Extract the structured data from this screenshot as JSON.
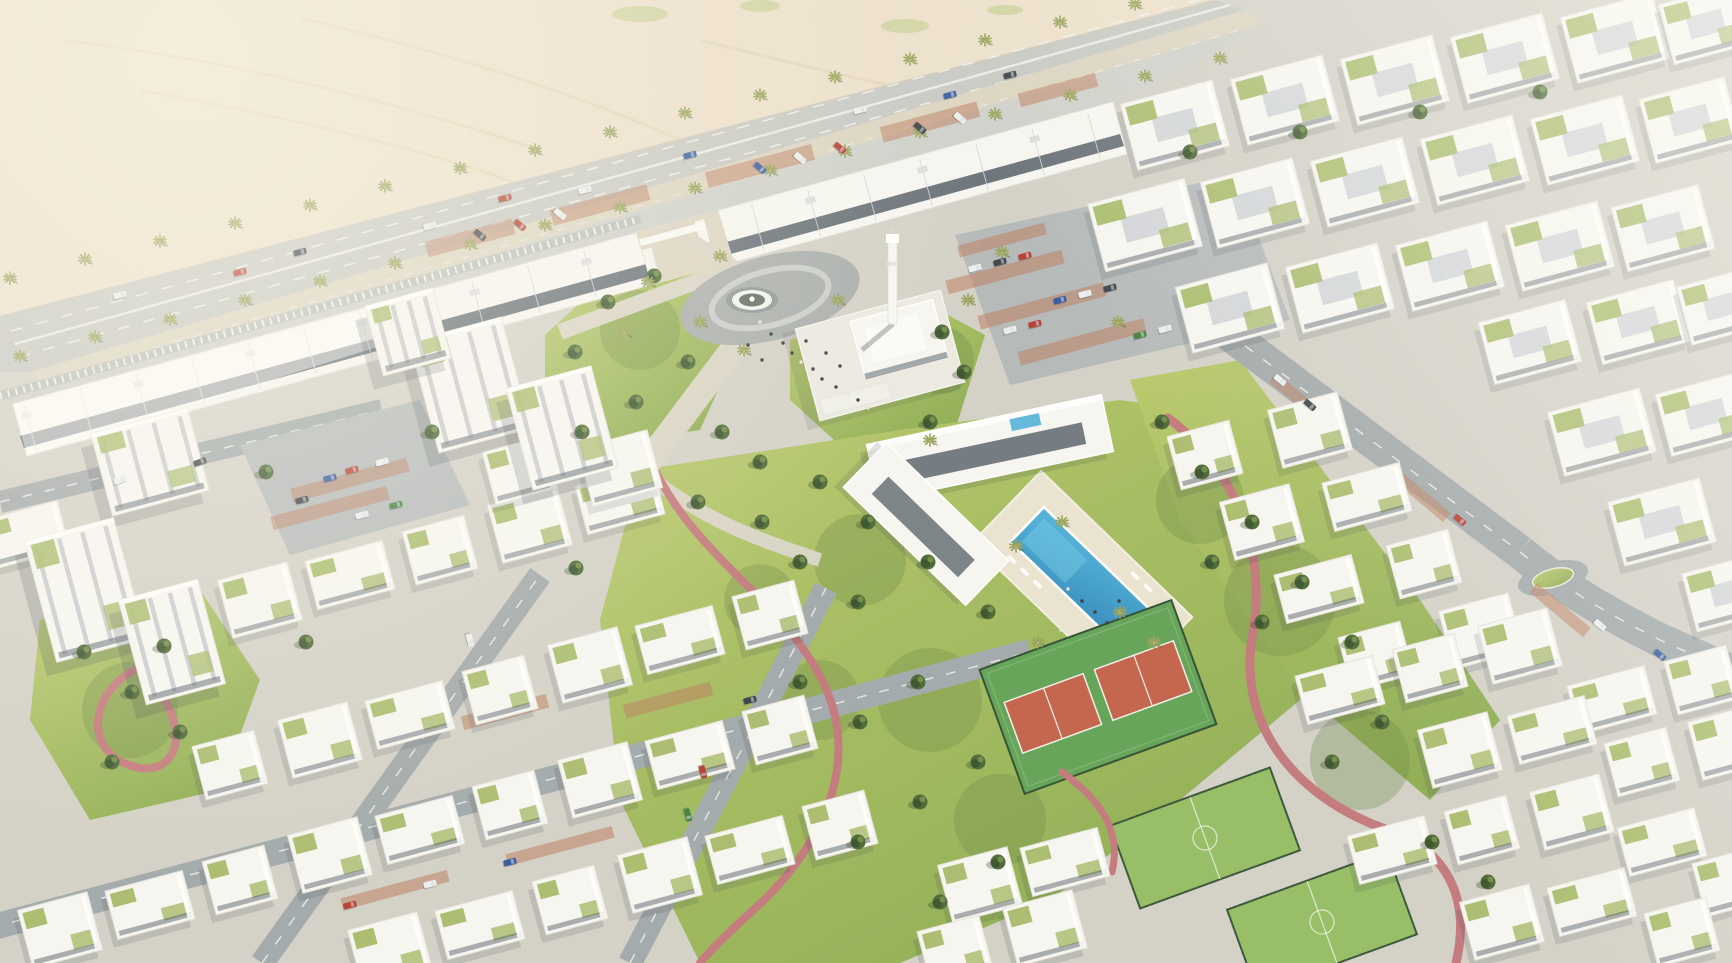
{
  "meta": {
    "kind": "aerial-architectural-render",
    "width": 1732,
    "height": 963
  },
  "palette": {
    "sand": "#ecdfca",
    "sand_track": "#e2d3b8",
    "sand_edge": "#d9cbb0",
    "ground": "#d2cfc6",
    "highway": "#c6c7c2",
    "sidewalk": "#dbd3c0",
    "service": "#cdcfca",
    "road_dark": "#9fa6a9",
    "parking": "#b2b7b8",
    "plaza": "#a7abaa",
    "walk": "#d8d3c4",
    "marking": "#f0f2ef",
    "grass_light": "#b7c766",
    "grass_mid": "#8aab4e",
    "grass_shadow": "#66863f",
    "tree": "#45622f",
    "tree_dark": "#2f4a24",
    "tree_light": "#6f8c45",
    "palm": "#94a155",
    "trunk": "#c7ad80",
    "building": "#f7f6f2",
    "building_shade": "#cdd1d7",
    "building_dark": "#97a0aa",
    "glass": "#3d4a55",
    "green_roof": "#a3b763",
    "pool": "#3fa9d8",
    "pool_deep": "#2b84b8",
    "pool_light": "#6cc3e4",
    "court_clay": "#c25c45",
    "court_green": "#5da052",
    "pitch_green": "#93bb60",
    "track_pink": "#c17478",
    "terracotta": "#b97a5b",
    "shadow": "#2e3542",
    "car_red": "#b5372a",
    "car_blue": "#30549c",
    "car_white": "#eceff0",
    "car_dark": "#363b41",
    "car_green": "#3f7d3c",
    "car_orange": "#cf7a2e"
  },
  "scene": {
    "features": [
      {
        "id": "desert",
        "name": "desert-plain"
      },
      {
        "id": "highway",
        "name": "palm-lined-boulevard"
      },
      {
        "id": "retail",
        "name": "retail-strip"
      },
      {
        "id": "gate",
        "name": "community-entrance-gate"
      },
      {
        "id": "plaza",
        "name": "fountain-plaza"
      },
      {
        "id": "mosque",
        "name": "mosque-with-minaret"
      },
      {
        "id": "parking",
        "name": "surface-parking"
      },
      {
        "id": "clubhouse",
        "name": "clubhouse"
      },
      {
        "id": "pool",
        "name": "swimming-pool"
      },
      {
        "id": "tennis",
        "name": "tennis-courts"
      },
      {
        "id": "pitches",
        "name": "fenced-sports-pitches"
      },
      {
        "id": "track",
        "name": "jogging-track"
      },
      {
        "id": "blocks",
        "name": "white-apartment-blocks"
      },
      {
        "id": "park",
        "name": "landscaped-park"
      }
    ]
  },
  "layout": {
    "palms": [
      [
        10,
        278
      ],
      [
        85,
        259
      ],
      [
        160,
        241
      ],
      [
        235,
        223
      ],
      [
        310,
        205
      ],
      [
        385,
        186
      ],
      [
        460,
        168
      ],
      [
        535,
        150
      ],
      [
        610,
        132
      ],
      [
        685,
        113
      ],
      [
        760,
        95
      ],
      [
        835,
        77
      ],
      [
        910,
        59
      ],
      [
        985,
        40
      ],
      [
        1060,
        22
      ],
      [
        1135,
        4
      ],
      [
        20,
        356
      ],
      [
        95,
        337
      ],
      [
        170,
        319
      ],
      [
        245,
        300
      ],
      [
        320,
        281
      ],
      [
        395,
        263
      ],
      [
        470,
        244
      ],
      [
        545,
        225
      ],
      [
        620,
        207
      ],
      [
        695,
        188
      ],
      [
        770,
        170
      ],
      [
        845,
        151
      ],
      [
        920,
        132
      ],
      [
        995,
        114
      ],
      [
        1070,
        95
      ],
      [
        1145,
        76
      ],
      [
        1220,
        58
      ],
      [
        700,
        322
      ],
      [
        744,
        350
      ],
      [
        624,
        332
      ],
      [
        838,
        300
      ],
      [
        648,
        282
      ],
      [
        720,
        256
      ],
      [
        1016,
        546
      ],
      [
        1062,
        522
      ],
      [
        1120,
        612
      ],
      [
        1154,
        642
      ],
      [
        1038,
        642
      ],
      [
        1002,
        252
      ],
      [
        1118,
        322
      ],
      [
        930,
        440
      ],
      [
        968,
        300
      ]
    ],
    "trees": [
      [
        575,
        352
      ],
      [
        608,
        302
      ],
      [
        654,
        276
      ],
      [
        688,
        362
      ],
      [
        636,
        402
      ],
      [
        722,
        432
      ],
      [
        760,
        462
      ],
      [
        582,
        432
      ],
      [
        942,
        332
      ],
      [
        964,
        372
      ],
      [
        930,
        422
      ],
      [
        820,
        482
      ],
      [
        868,
        522
      ],
      [
        928,
        562
      ],
      [
        988,
        612
      ],
      [
        858,
        602
      ],
      [
        800,
        562
      ],
      [
        762,
        522
      ],
      [
        918,
        682
      ],
      [
        860,
        722
      ],
      [
        800,
        682
      ],
      [
        978,
        762
      ],
      [
        920,
        802
      ],
      [
        858,
        842
      ],
      [
        998,
        862
      ],
      [
        940,
        902
      ],
      [
        698,
        502
      ],
      [
        1162,
        422
      ],
      [
        1202,
        472
      ],
      [
        1252,
        522
      ],
      [
        1302,
        582
      ],
      [
        1352,
        642
      ],
      [
        1262,
        622
      ],
      [
        1212,
        562
      ],
      [
        1382,
        722
      ],
      [
        1332,
        762
      ],
      [
        1432,
        842
      ],
      [
        1488,
        882
      ],
      [
        84,
        652
      ],
      [
        132,
        692
      ],
      [
        180,
        732
      ],
      [
        112,
        762
      ],
      [
        164,
        646
      ],
      [
        266,
        472
      ],
      [
        432,
        432
      ],
      [
        306,
        642
      ],
      [
        576,
        568
      ],
      [
        1190,
        152
      ],
      [
        1300,
        132
      ],
      [
        1420,
        112
      ],
      [
        1540,
        92
      ]
    ],
    "shade_blobs": [
      [
        860,
        560,
        46
      ],
      [
        930,
        700,
        52
      ],
      [
        820,
        700,
        40
      ],
      [
        1280,
        600,
        56
      ],
      [
        1200,
        500,
        44
      ],
      [
        130,
        710,
        48
      ],
      [
        640,
        330,
        40
      ],
      [
        940,
        360,
        34
      ],
      [
        1000,
        820,
        46
      ],
      [
        1360,
        760,
        50
      ],
      [
        760,
        600,
        36
      ]
    ],
    "cars": [
      [
        120,
        295,
        -14.5,
        "car_white"
      ],
      [
        240,
        272,
        -14.5,
        "car_red"
      ],
      [
        300,
        252,
        -14.5,
        "car_dark"
      ],
      [
        430,
        226,
        -14.5,
        "car_white"
      ],
      [
        505,
        198,
        -14.5,
        "car_red"
      ],
      [
        585,
        190,
        -14.5,
        "car_white"
      ],
      [
        690,
        155,
        -14.5,
        "car_blue"
      ],
      [
        860,
        110,
        -14.5,
        "car_white"
      ],
      [
        950,
        95,
        -14.5,
        "car_blue"
      ],
      [
        1010,
        75,
        -14.5,
        "car_dark"
      ],
      [
        480,
        235,
        40,
        "car_dark"
      ],
      [
        520,
        225,
        40,
        "car_red"
      ],
      [
        560,
        214,
        40,
        "car_white"
      ],
      [
        760,
        168,
        40,
        "car_blue"
      ],
      [
        800,
        158,
        40,
        "car_white"
      ],
      [
        840,
        148,
        40,
        "car_red"
      ],
      [
        920,
        128,
        40,
        "car_dark"
      ],
      [
        960,
        118,
        40,
        "car_white"
      ],
      [
        975,
        268,
        -15,
        "car_white"
      ],
      [
        1000,
        262,
        -15,
        "car_dark"
      ],
      [
        1025,
        256,
        -15,
        "car_red"
      ],
      [
        1060,
        300,
        -15,
        "car_blue"
      ],
      [
        1085,
        294,
        -15,
        "car_white"
      ],
      [
        1110,
        288,
        -15,
        "car_dark"
      ],
      [
        1010,
        330,
        -15,
        "car_white"
      ],
      [
        1035,
        324,
        -15,
        "car_red"
      ],
      [
        1140,
        335,
        -15,
        "car_green"
      ],
      [
        1165,
        329,
        -15,
        "car_white"
      ],
      [
        1280,
        380,
        40,
        "car_white"
      ],
      [
        1310,
        405,
        40,
        "car_dark"
      ],
      [
        1460,
        520,
        40,
        "car_red"
      ],
      [
        1600,
        625,
        40,
        "car_white"
      ],
      [
        1660,
        655,
        40,
        "car_blue"
      ],
      [
        350,
        905,
        -15,
        "car_red"
      ],
      [
        430,
        884,
        -15,
        "car_white"
      ],
      [
        510,
        862,
        -15,
        "car_blue"
      ],
      [
        688,
        815,
        75,
        "car_green"
      ],
      [
        703,
        772,
        75,
        "car_red"
      ],
      [
        470,
        640,
        75,
        "car_white"
      ],
      [
        750,
        700,
        -15,
        "car_dark"
      ],
      [
        120,
        480,
        -20,
        "car_white"
      ],
      [
        200,
        462,
        -20,
        "car_dark"
      ],
      [
        352,
        470,
        -15,
        "car_red"
      ],
      [
        382,
        462,
        -15,
        "car_white"
      ],
      [
        330,
        478,
        -15,
        "car_blue"
      ],
      [
        302,
        500,
        -15,
        "car_dark"
      ],
      [
        396,
        505,
        -15,
        "car_green"
      ],
      [
        362,
        515,
        -15,
        "car_white"
      ]
    ],
    "bays": [
      [
        470,
        238,
        90,
        16,
        -15
      ],
      [
        600,
        205,
        100,
        16,
        -15
      ],
      [
        760,
        166,
        110,
        16,
        -15
      ],
      [
        930,
        122,
        100,
        16,
        -15
      ],
      [
        1058,
        90,
        80,
        14,
        -15
      ],
      [
        1005,
        272,
        120,
        14,
        -15
      ],
      [
        1042,
        306,
        130,
        14,
        -15
      ],
      [
        1082,
        342,
        130,
        14,
        -15
      ],
      [
        1002,
        240,
        90,
        12,
        -15
      ],
      [
        1300,
        400,
        70,
        12,
        40
      ],
      [
        1420,
        495,
        70,
        12,
        40
      ],
      [
        1560,
        610,
        70,
        12,
        40
      ],
      [
        395,
        890,
        110,
        12,
        -15
      ],
      [
        560,
        846,
        110,
        12,
        -15
      ],
      [
        668,
        700,
        14,
        90,
        75
      ],
      [
        505,
        712,
        14,
        88,
        75
      ],
      [
        350,
        480,
        120,
        14,
        -15
      ],
      [
        330,
        508,
        120,
        14,
        -15
      ]
    ],
    "blocksA": [
      [
        1175,
        125,
        95,
        68
      ],
      [
        1285,
        100,
        95,
        68
      ],
      [
        1395,
        80,
        95,
        68
      ],
      [
        1505,
        58,
        95,
        68
      ],
      [
        1615,
        38,
        95,
        68
      ],
      [
        1706,
        24,
        82,
        62
      ],
      [
        1145,
        225,
        100,
        70
      ],
      [
        1255,
        203,
        95,
        68
      ],
      [
        1365,
        182,
        95,
        68
      ],
      [
        1475,
        160,
        95,
        68
      ],
      [
        1585,
        140,
        95,
        68
      ],
      [
        1690,
        120,
        88,
        66
      ],
      [
        1230,
        308,
        95,
        68
      ],
      [
        1340,
        288,
        95,
        68
      ],
      [
        1450,
        266,
        95,
        68
      ],
      [
        1560,
        246,
        95,
        68
      ],
      [
        1663,
        228,
        90,
        66
      ],
      [
        1530,
        342,
        90,
        64
      ],
      [
        1638,
        322,
        90,
        64
      ],
      [
        1722,
        306,
        78,
        60
      ],
      [
        1602,
        432,
        95,
        66
      ],
      [
        1706,
        414,
        88,
        64
      ],
      [
        1662,
        522,
        95,
        66
      ],
      [
        1730,
        592,
        84,
        60
      ]
    ],
    "blocksB": [
      [
        1205,
        455
      ],
      [
        1262,
        522
      ],
      [
        1319,
        589
      ],
      [
        1376,
        656
      ],
      [
        1310,
        430
      ],
      [
        1367,
        497
      ],
      [
        1424,
        564
      ],
      [
        1481,
        631
      ],
      [
        1340,
        690
      ],
      [
        1430,
        668
      ],
      [
        1520,
        646
      ],
      [
        1612,
        700
      ],
      [
        1702,
        680
      ],
      [
        1460,
        750
      ],
      [
        1552,
        730
      ],
      [
        1642,
        762
      ],
      [
        1730,
        742
      ],
      [
        1392,
        850
      ],
      [
        1482,
        830
      ],
      [
        1572,
        812
      ],
      [
        1662,
        842
      ],
      [
        1730,
        882
      ],
      [
        1502,
        922
      ],
      [
        1592,
        902
      ],
      [
        1682,
        932
      ],
      [
        260,
        600
      ],
      [
        350,
        575
      ],
      [
        440,
        550
      ],
      [
        530,
        525
      ],
      [
        620,
        500
      ],
      [
        230,
        765
      ],
      [
        320,
        740
      ],
      [
        410,
        715
      ],
      [
        500,
        690
      ],
      [
        590,
        665
      ],
      [
        680,
        640
      ],
      [
        770,
        615
      ],
      [
        60,
        930
      ],
      [
        150,
        905
      ],
      [
        240,
        880
      ],
      [
        330,
        855
      ],
      [
        420,
        830
      ],
      [
        510,
        805
      ],
      [
        600,
        780
      ],
      [
        690,
        755
      ],
      [
        780,
        730
      ],
      [
        390,
        950
      ],
      [
        480,
        925
      ],
      [
        570,
        900
      ],
      [
        660,
        875
      ],
      [
        750,
        850
      ],
      [
        840,
        825
      ],
      [
        980,
        885
      ],
      [
        1065,
        862
      ],
      [
        955,
        950
      ],
      [
        1045,
        928
      ],
      [
        25,
        535
      ],
      [
        520,
        470
      ],
      [
        620,
        468
      ]
    ],
    "towers": [
      [
        470,
        385,
        95,
        115
      ],
      [
        562,
        428,
        88,
        105
      ],
      [
        150,
        462,
        100,
        85
      ],
      [
        85,
        590,
        92,
        125
      ],
      [
        172,
        642,
        82,
        108
      ],
      [
        408,
        332,
        70,
        72
      ]
    ],
    "people": [
      [
        760,
        322
      ],
      [
        771,
        334
      ],
      [
        783,
        343
      ],
      [
        792,
        353
      ],
      [
        801,
        362
      ],
      [
        813,
        369
      ],
      [
        822,
        379
      ],
      [
        836,
        387
      ],
      [
        848,
        393
      ],
      [
        762,
        360
      ],
      [
        748,
        345
      ],
      [
        858,
        400
      ],
      [
        868,
        408
      ],
      [
        806,
        341
      ],
      [
        826,
        353
      ],
      [
        840,
        366
      ],
      [
        1068,
        589
      ],
      [
        1082,
        601
      ],
      [
        1095,
        612
      ],
      [
        1107,
        623
      ],
      [
        1061,
        630
      ],
      [
        1119,
        601
      ]
    ]
  }
}
